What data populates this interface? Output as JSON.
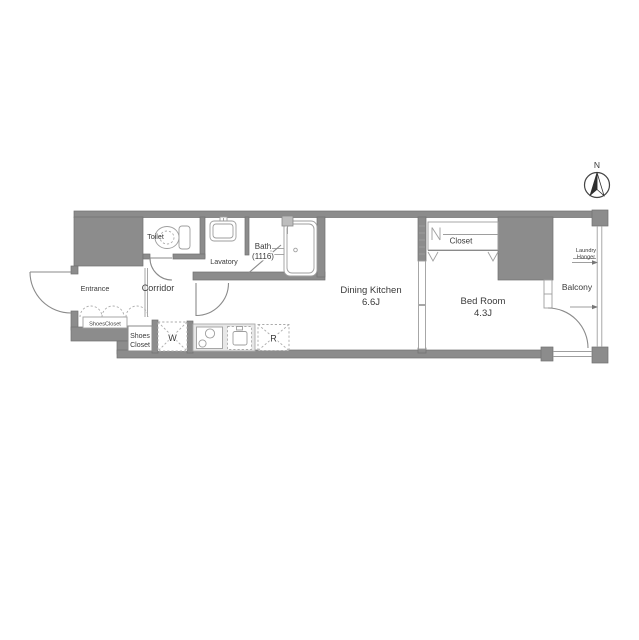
{
  "compass": {
    "north_label": "N"
  },
  "rooms": {
    "entrance": {
      "label": "Entrance"
    },
    "corridor": {
      "label": "Corridor"
    },
    "toilet": {
      "label": "Toilet"
    },
    "lavatory": {
      "label": "Lavatory"
    },
    "bath": {
      "label": "Bath",
      "size": "(1116)"
    },
    "dining_kitchen": {
      "label": "Dining Kitchen",
      "size": "6.6J"
    },
    "bed_room": {
      "label": "Bed Room",
      "size": "4.3J"
    },
    "closet": {
      "label": "Closet"
    },
    "shoes_closet_cabinet": {
      "label": "ShoesCloset"
    },
    "shoes_closet": {
      "label_line1": "Shoes",
      "label_line2": "Closet"
    },
    "balcony": {
      "label": "Balcony"
    }
  },
  "fixtures": {
    "washing_machine": {
      "label": "W"
    },
    "refrigerator": {
      "label": "R"
    },
    "laundry_hanger": {
      "label_line1": "Laundry",
      "label_line2": "Hanger"
    }
  },
  "colors": {
    "wall": "#8c8c8c",
    "wall_edge": "#707070",
    "line": "#9e9e9e",
    "door": "#8a8a8a",
    "dash": "#ababab",
    "counter": "#e7e7e7",
    "text": "#3a3a3a"
  }
}
